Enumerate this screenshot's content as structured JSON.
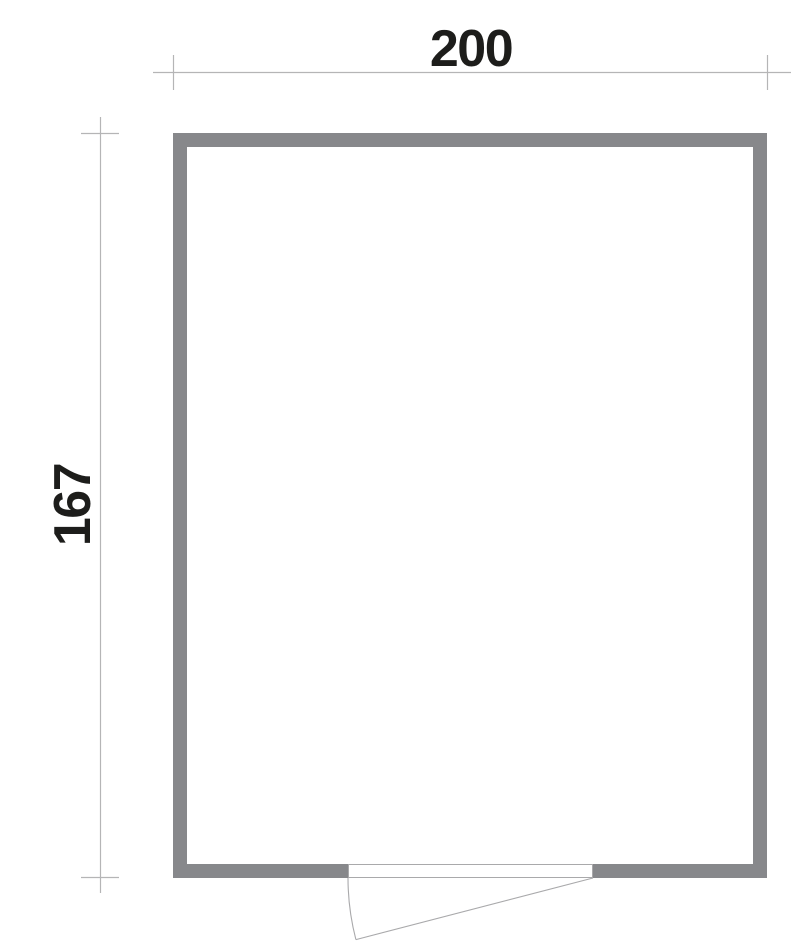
{
  "drawing": {
    "type": "floor-plan",
    "dimensions": {
      "width": {
        "label": "200"
      },
      "height": {
        "label": "167"
      }
    },
    "door": {
      "location": "bottom-wall",
      "hinge": "right",
      "symbol": "leaf-with-swing-arc"
    },
    "colors": {
      "background": "#ffffff",
      "wall": "#87888b",
      "dimension_line": "#b5b5b6",
      "door_line": "#a9a9ab",
      "label_text": "#1d1d1b"
    }
  }
}
